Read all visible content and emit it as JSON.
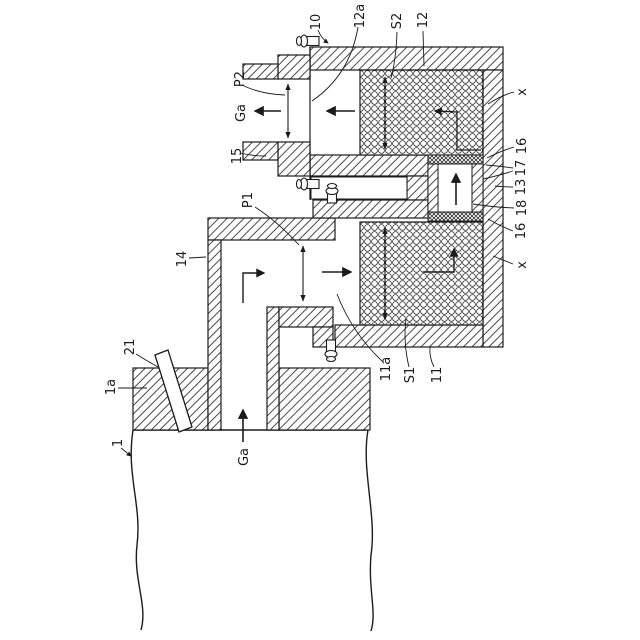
{
  "figure": {
    "kind": "patent-cross-section-diagram",
    "labels": {
      "l10": "10",
      "l12a": "12a",
      "lS2": "S2",
      "l12": "12",
      "lx_top": "x",
      "l16_top": "16",
      "l17": "17",
      "l13": "13",
      "l18": "18",
      "l16_bottom": "16",
      "lx_bottom": "x",
      "l11a": "11a",
      "lS1": "S1",
      "l11": "11",
      "lP2": "P2",
      "lGa_left": "Ga",
      "l15": "15",
      "lP1": "P1",
      "l14": "14",
      "l21": "21",
      "l1a": "1a",
      "l1": "1",
      "lGa_bottom": "Ga"
    },
    "colors": {
      "line": "#1b1b1b",
      "hatch_line": "#4a4a4a",
      "background": "#ffffff"
    }
  }
}
